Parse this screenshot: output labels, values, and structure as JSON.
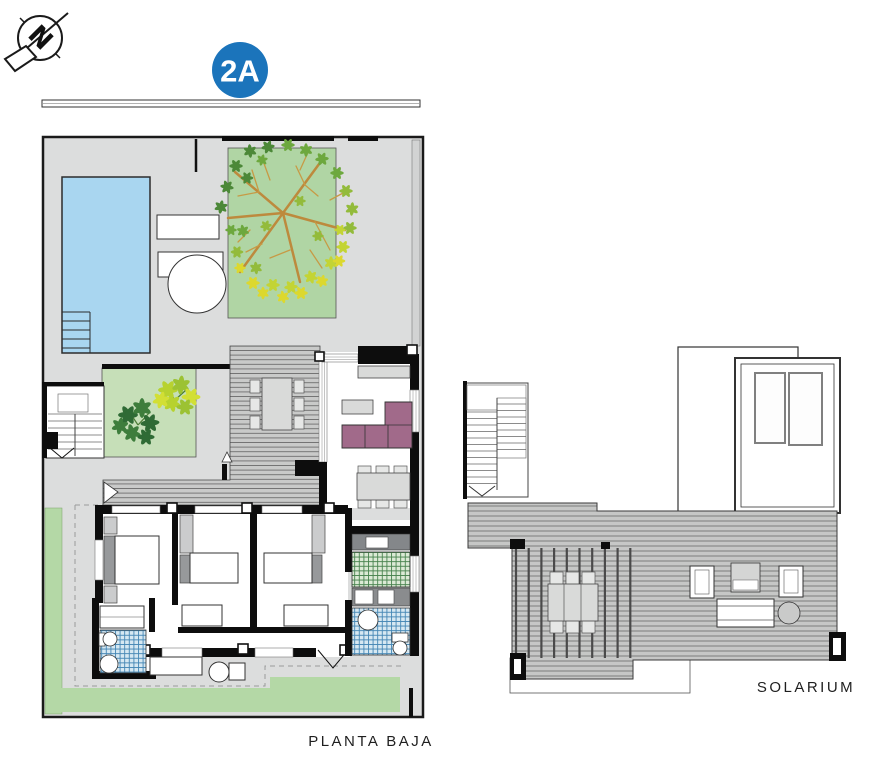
{
  "header": {
    "unit_badge": "2A"
  },
  "labels": {
    "ground_floor": "PLANTA BAJA",
    "solarium": "SOLARIUM"
  },
  "icons": {
    "north_arrow": "north-arrow-icon",
    "north_letter": "N"
  },
  "colors": {
    "badge_blue": "#1b74bb",
    "pool_blue": "#a9d6f0",
    "grass_green": "#b4d8a6",
    "tree_bed_green": "#b0d5a4",
    "planter_green": "#c6dfb8",
    "terrace_gray": "#dcdddd",
    "deck_gray": "#c8c9c8",
    "sofa_plum": "#a16a8a",
    "tile_blue_line": "#4486b4",
    "tile_green_line": "#47824d",
    "furniture_gray": "#d9dad9",
    "counter_dark": "#84878a",
    "wall_black": "#0d0d0d"
  }
}
